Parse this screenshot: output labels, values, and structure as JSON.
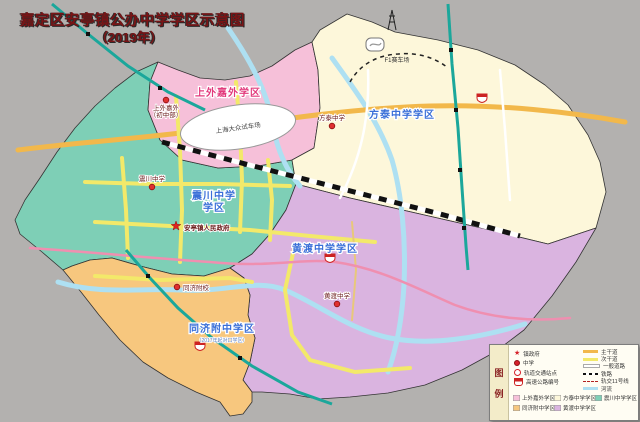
{
  "title": {
    "line1": "嘉定区安亭镇公办中学学区示意图",
    "line2": "（2019年）"
  },
  "map": {
    "districts": [
      {
        "name": "上外嘉外学区",
        "color": "#f6c0d9",
        "label_color": "#e23a7c"
      },
      {
        "name": "方泰中学学区",
        "color": "#fdf7da",
        "label_color": "#3a6fd8"
      },
      {
        "name": "震川中学学区",
        "label_l1": "震川中学",
        "label_l2": "学区",
        "color": "#7ecfb6",
        "label_color": "#3a6fd8"
      },
      {
        "name": "同济附中学区",
        "sub": "（2017年起对口学区）",
        "color": "#f7c77e",
        "label_color": "#3a6fd8"
      },
      {
        "name": "黄渡中学学区",
        "color": "#dab4e0",
        "label_color": "#3a6fd8"
      }
    ],
    "pois": [
      {
        "type": "school",
        "label": "上外嘉外",
        "label2": "（初中部）"
      },
      {
        "type": "school",
        "label": "方泰中学"
      },
      {
        "type": "school",
        "label": "震川中学"
      },
      {
        "type": "school",
        "label": "黄渡中学"
      },
      {
        "type": "school",
        "label": "同济附校"
      },
      {
        "type": "government",
        "label": "安亭镇人民政府"
      }
    ],
    "features": {
      "test_track": "上海大众试车场",
      "f1": "F1赛车场"
    }
  },
  "legend": {
    "title_char1": "图",
    "title_char2": "例",
    "point_items": [
      {
        "icon": "star-icon",
        "label": "镇政府"
      },
      {
        "icon": "school-dot-icon",
        "label": "中学"
      },
      {
        "icon": "metro-station-icon",
        "label": "轨道交通站点"
      },
      {
        "icon": "highway-shield-icon",
        "label": "高速公路编号"
      }
    ],
    "line_items": [
      {
        "label": "主干道"
      },
      {
        "label": "次干道"
      },
      {
        "label": "一般道路"
      },
      {
        "label": "铁路"
      },
      {
        "label": "轨交11号线"
      },
      {
        "label": "河流"
      }
    ],
    "colors": {
      "main_road": "#f2b84b",
      "secondary_road": "#f3e96a",
      "river": "#aee0f2",
      "metro": "#1ba79b"
    }
  }
}
